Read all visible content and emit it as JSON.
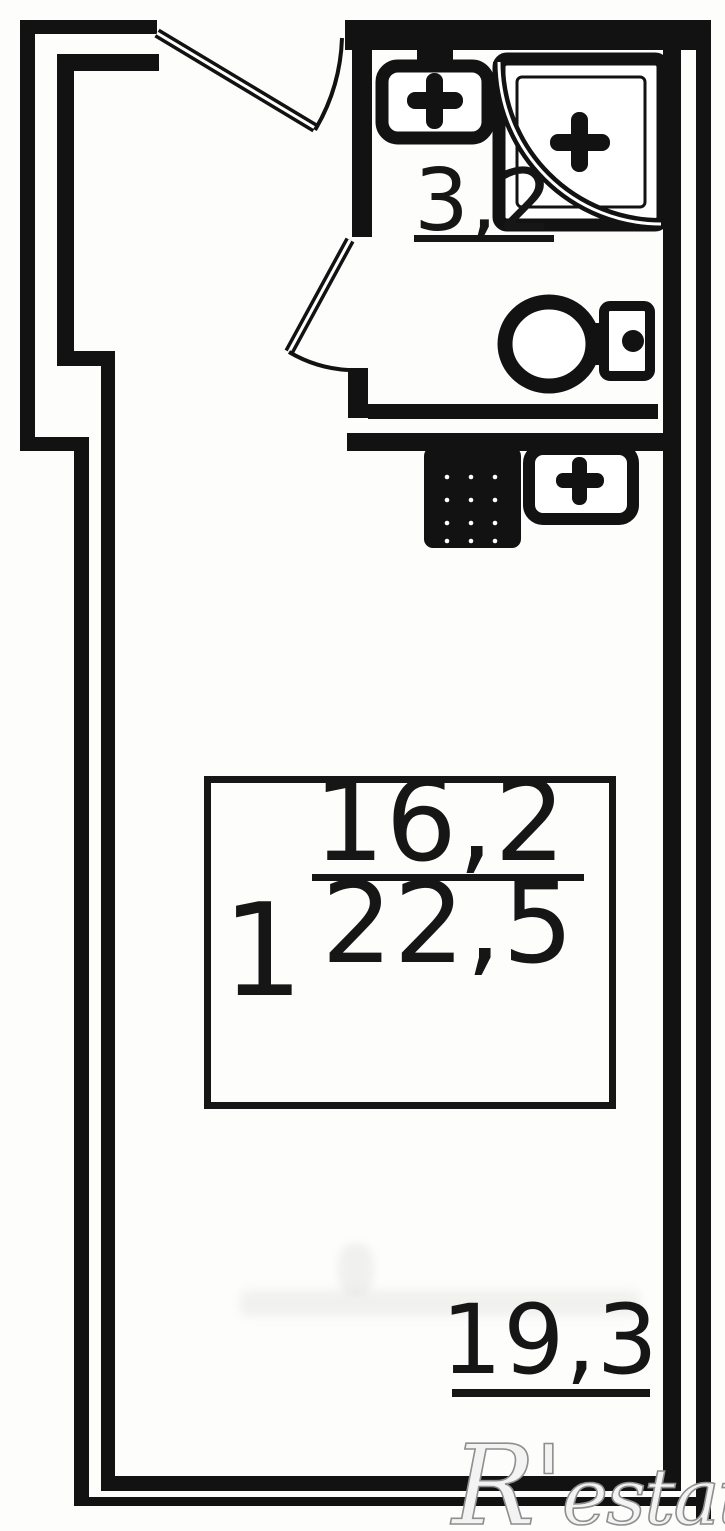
{
  "plan": {
    "type": "studio-apartment-floor-plan",
    "labels": {
      "bathroom_area": "3,2",
      "room_number": "1",
      "living_area": "16,2",
      "total_area": "22,5",
      "balcony_area": "19,3"
    },
    "fixtures": [
      "entry-door",
      "bathroom-door",
      "bathroom-sink",
      "shower",
      "toilet",
      "stove",
      "kitchen-sink"
    ],
    "colors": {
      "wall": "#121212",
      "background": "#fdfdfc",
      "label_text": "#161616",
      "watermark_outline": "#8f8f8f",
      "watermark_fill": "#ffffff"
    }
  },
  "watermark": {
    "brand": "R'estate"
  }
}
